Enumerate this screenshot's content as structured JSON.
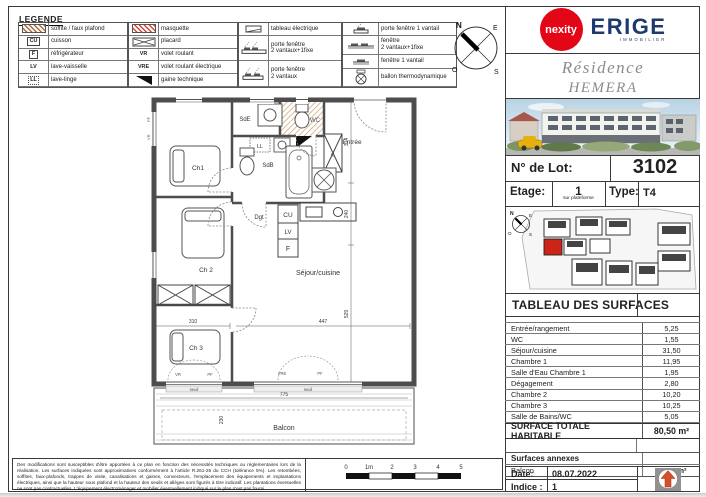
{
  "legend": {
    "title": "LEGENDE",
    "col1": [
      {
        "label": "soffite / faux plafond"
      },
      {
        "label": "cuisson",
        "icon_text": "CU"
      },
      {
        "label": "réfrigérateur",
        "icon_text": "F"
      },
      {
        "label": "lave-vaisselle",
        "icon_text": "LV"
      },
      {
        "label": "lave-linge",
        "icon_text": "LL"
      }
    ],
    "col2": [
      {
        "label": "masquette"
      },
      {
        "label": "placard"
      },
      {
        "label": "volet roulant",
        "icon_text": "VR"
      },
      {
        "label": "volet roulant électrique",
        "icon_text": "VRE"
      },
      {
        "label": "gaine technique"
      }
    ],
    "col3": [
      {
        "label": "tableau électrique"
      },
      {
        "label": "porte fenêtre\n2 vantaux+1fixe"
      },
      {
        "label": "porte fenêtre\n2 vantaux"
      }
    ],
    "col4": [
      {
        "label": "porte fenêtre 1 vantail"
      },
      {
        "label": "fenêtre\n2 vantaux+1fixe"
      },
      {
        "label": "fenêtre 1 vantail"
      },
      {
        "label": "ballon thermodynamique"
      }
    ]
  },
  "compass": {
    "n": "N",
    "e": "E",
    "o": "O",
    "s": "S"
  },
  "plan": {
    "rooms": {
      "ch1": "Ch1",
      "ch2": "Ch 2",
      "ch3": "Ch 3",
      "sde": "SdE",
      "wc": "WC",
      "sdb": "SdB",
      "ll": "LL",
      "pl": "PL",
      "entree": "Entrée",
      "dgt": "Dgt",
      "cu": "CU",
      "lv": "LV",
      "f": "F",
      "sejour": "Séjour/cuisine",
      "balcon": "Balcon"
    },
    "dims": {
      "w310": "310",
      "w447": "447",
      "w775": "775",
      "d230": "230",
      "h314": "314",
      "h240": "240",
      "h529": "529"
    },
    "windows": {
      "pf": "PF",
      "vr": "VR",
      "vre": "VRE",
      "seuil": "seuil"
    }
  },
  "scalebar": {
    "labels": [
      "0",
      "1m",
      "2",
      "3",
      "4",
      "5"
    ]
  },
  "disclaimer": "Des modifications sont susceptibles d'être apportées à ce plan en fonction des nécessités techniques ou réglementaires lors de la réalisation. Les surfaces indiquées sont approximatives conformément à l'article R.261-25 du CCH (tolérance 5%). Les retombées, soffites, faux-plafonds, trappes de visite, canalisations et gaines, convecteurs, l'emplacement des équipements et implantations électriques, ainsi que la hauteur sous plafond et la hauteur des seuils et allèges sont figurés à titre indicatif. Les plantations éventuelles ne sont pas contractuelles. L'équipement électroménager et mobilier éventuellement indiqué sur le plan n'est pas fourni.",
  "panel": {
    "brand": {
      "nexity": "nexity",
      "erige": "ERIGE",
      "erige_sub": "IMMOBILIER"
    },
    "residence_line1": "Résidence",
    "residence_line2": "HEMERA",
    "lot": {
      "label": "N° de Lot:",
      "value": "3102"
    },
    "etage": {
      "label": "Etage:",
      "value": "1",
      "sub": "sur plateforme"
    },
    "type": {
      "label": "Type:",
      "value": "T4"
    },
    "surfaces": {
      "title": "TABLEAU DES SURFACES",
      "rows": [
        {
          "label": "Entrée/rangement",
          "value": "5,25"
        },
        {
          "label": "WC",
          "value": "1,55"
        },
        {
          "label": "Séjour/cuisine",
          "value": "31,50"
        },
        {
          "label": "Chambre 1",
          "value": "11,95"
        },
        {
          "label": "Salle d'Eau Chambre 1",
          "value": "1,95"
        },
        {
          "label": "Dégagement",
          "value": "2,80"
        },
        {
          "label": "Chambre 2",
          "value": "10,20"
        },
        {
          "label": "Chambre 3",
          "value": "10,25"
        },
        {
          "label": "Salle de Bains/WC",
          "value": "5,05"
        }
      ],
      "total_label": "SURFACE TOTALE HABITABLE",
      "total_value": "80,50 m²"
    },
    "annexes": {
      "title": "Surfaces annexes",
      "balcon_label": "Balcon",
      "balcon_value": "17,65 m²"
    },
    "date": {
      "label": "Date:",
      "value": "08.07.2022"
    },
    "indice": {
      "label": "Indice :",
      "value": "1"
    }
  },
  "colors": {
    "wall": "#4d4d4d",
    "unit_red": "#cc2417",
    "nexity_red": "#e30617",
    "erige_navy": "#1c3a6e",
    "hatch_beige": "#c9a06a"
  }
}
